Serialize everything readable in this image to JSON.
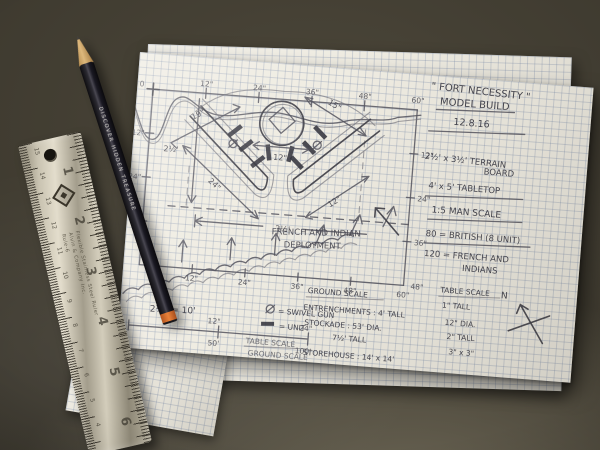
{
  "notes": {
    "title_line1": "\" FORT NECESSITY \"",
    "title_line2": "MODEL BUILD",
    "date": "12.8.16",
    "board_line1": "2½' x 3½' TERRAIN",
    "board_line2": "BOARD",
    "tabletop": "4' x 5' TABLETOP",
    "man_scale": "1:5 MAN SCALE",
    "british": "80 = BRITISH (8 UNIT)",
    "french_line1": "120 = FRENCH AND",
    "french_line2": "INDIANS"
  },
  "plan": {
    "origin_label": "0",
    "top_ticks": [
      "12\"",
      "24\"",
      "36\"",
      "48\"",
      "60\""
    ],
    "left_ticks": [
      "12\"",
      "24\""
    ],
    "right_ticks": [
      "12\"",
      "24\"",
      "36\"",
      "48\""
    ],
    "bottom_ticks": [
      "12\"",
      "24\"",
      "36\"",
      "48\"",
      "60\""
    ],
    "meas_19": "19\"",
    "meas_15": "15\"",
    "meas_12_center": "12\"",
    "meas_24": "24\"",
    "meas_12_right": "12\"",
    "meas_height": "2½'",
    "meas_width": "3½'",
    "deployment_line1": "FRENCH AND INDIAN",
    "deployment_line2": "DEPLOYMENT",
    "compass_n": "N"
  },
  "scale_notes": {
    "equation": "2½\" = 10'",
    "bar_mid_top": "12\"",
    "bar_mid_bottom": "50'",
    "bar_end_top": "24\"",
    "bar_end_bottom": "100'",
    "legend_swivel": "= SWIVEL GUN",
    "legend_unit": "= UNIT",
    "label_table": "TABLE SCALE",
    "label_ground": "GROUND SCALE"
  },
  "size_table": {
    "ground_header": "GROUND SCALE",
    "table_header": "TABLE SCALE",
    "table_sub": "1\" TALL",
    "rows_ground": [
      "ENTRENCHMENTS : 4' TALL",
      "STOCKADE : 53' DIA.",
      "7½' TALL",
      "STOREHOUSE : 14' x 14'"
    ],
    "rows_table": [
      "12\" DIA.",
      "2\" TALL",
      "3\" x 3\""
    ]
  },
  "back_sheet_note": "IT APP      ENTRENCHMENTS     4\" TALL",
  "ruler": {
    "brand_line1": "Flexible Stainless Steel Ruler",
    "brand_line2": "Alvin & Company Inc.",
    "brand_line3": "Rule-6",
    "inch_numbers": [
      "1",
      "2",
      "3",
      "4",
      "5",
      "6"
    ],
    "cm_numbers": [
      "15",
      "14",
      "13",
      "12",
      "11",
      "10",
      "9",
      "8",
      "7",
      "6",
      "5",
      "4"
    ]
  },
  "pencil": {
    "imprint": "DISCOVER HIDDEN TREASURE"
  },
  "colors": {
    "paper": "#efece2",
    "grid_line": "#788aaa",
    "graphite": "#55555f",
    "table_surface": "#3a362c",
    "pencil_orange": "#ea823a",
    "steel": "#c9c3b1"
  }
}
